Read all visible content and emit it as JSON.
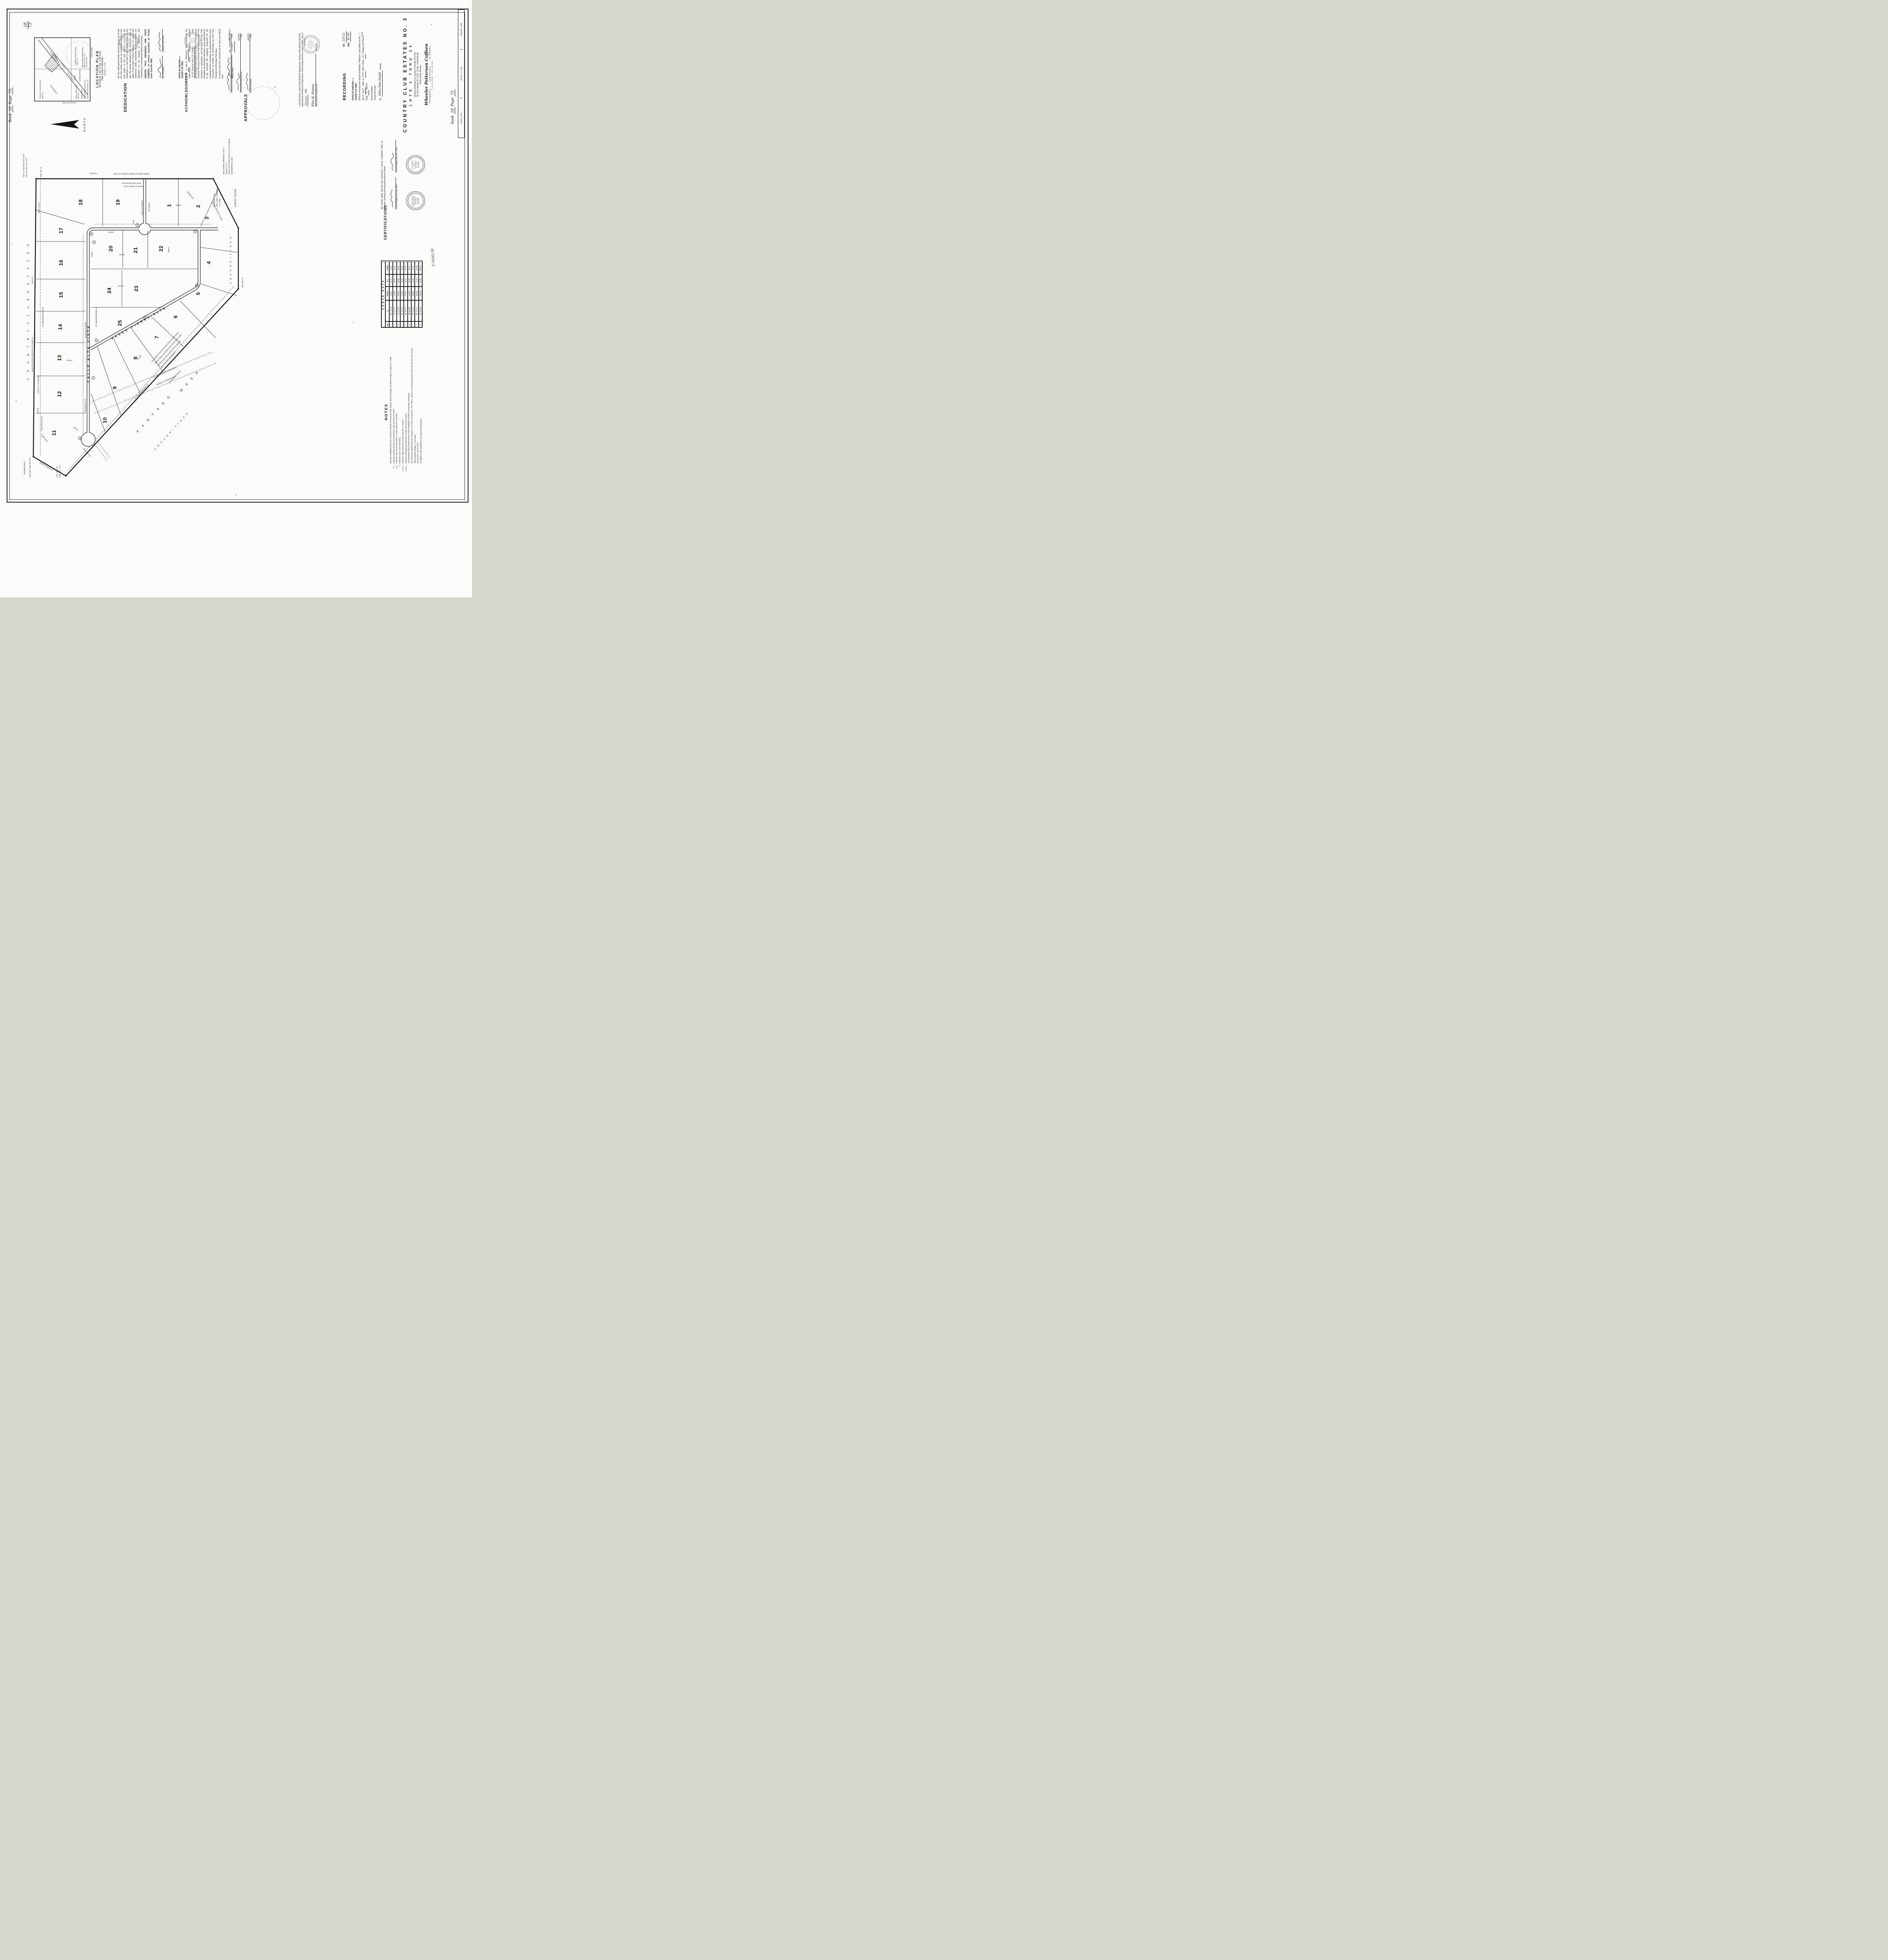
{
  "sheet": {
    "corner_note": {
      "top": "18",
      "bottom": "73"
    },
    "book_page_top": {
      "book_word": "Book",
      "book": "18",
      "page_word": "Page",
      "page": "73"
    },
    "book_page_bottom": {
      "book_word": "book",
      "book": "18",
      "page_word": "Page",
      "page": "73"
    },
    "file_number": "C-10-65-30"
  },
  "north": {
    "label": "NORTH"
  },
  "location_plan": {
    "title": "LOCATION PLAN",
    "line1": "SECTION 36, T.13S., R.14E., G.&S.R.&M.",
    "line2": "PIMA COUNTY, ARIZONA",
    "scale": "SCALE 3\" = 1 MI.",
    "labels": [
      "COUNTRY CLUB ESTATES",
      "M&P 8-75",
      "UNSUBDIVIDED",
      "PANTANO",
      "WASH",
      "UNSUBDIVIDED",
      "RAINBOW VISTA EST. ANNEX",
      "M&P 17-12",
      "SAHUARA AVENUE",
      "GLENN LOWELL ADD'N",
      "M&P 15-16",
      "GLENN STREET",
      "UNSUB.",
      "CRESTWOOD MEMORIAL PARK",
      "M&P 9-40, 9-47, 11-63,",
      "18-3, 18-4, 18-48",
      "CARLOS TERRACE M&P 12-18",
      "CASAS DE CARLOS M&P 10-96",
      "GRANT ROAD",
      "CRAYCROFT ROAD"
    ]
  },
  "dedication": {
    "heading": "DEDICATION",
    "body": "We the undersigned hereby warrant that we are all and the only parties having any record title interest in the land shown on this plat, and we consent to the subdivision of said land in the manner shown on this plat. We hereby dedicate to the use of the public all rights of way shown hereon, including all streets and easements. Utility easements as shown hereon are dedicated for the purpose of installation and maintenance of underground utilities and sewers.",
    "company": "ARIZONA TITLE INSURANCE AND TRUST COMPANY, an Arizona corporation, as Trustee under Trust No. 8008.",
    "sig1_label": "Vice President",
    "sig2_label": "Assistant Secretary",
    "seal": [
      "ARIZONA TITLE",
      "INSURANCE AND",
      "TRUST CO.",
      "· SEAL ·"
    ]
  },
  "acknowledgment": {
    "heading": "ACKNOWLEDGMENT",
    "state": "STATE OF ARIZONA",
    "ss": "s.s.",
    "county": "COUNTY OF PIMA",
    "pre": "On the",
    "day": "3",
    "mid": "day of",
    "month": "February",
    "post": "1966, before me, the undersigned officer, personally appeared",
    "names": "W. H. Driscoll and J. E. Green",
    "body2": "who acknowledged themselves to be the Vice President and Assistant Secretary of Arizona Title Insurance And Trust Company, a corporation, and that they as such Vice President and Assistant Secretary, being authorized so to do, executed the foregoing instrument for the purposes therein contained, by signing the name of the corporation, as trustee, by themselves as such Vice President and Assistant Secretary.",
    "witness": "In witness whereof I hereunto set my hand and official seal.",
    "notary_label": "Notary Public",
    "expires_pre": "My commission expires",
    "expires": "11-26-67",
    "seal": [
      "NOTARY",
      "PUBLIC",
      "PIMA CO.",
      "ARIZONA"
    ]
  },
  "approvals": {
    "heading": "APPROVALS",
    "rows": [
      {
        "label": "Sanitary District No. 1",
        "date_word": "Date",
        "date": "4/6/66"
      },
      {
        "label": "County Planning Director",
        "date_word": "Date",
        "date": "4/6/66"
      },
      {
        "label": "County Engineer",
        "date_word": "Date",
        "date": "4/6/66"
      }
    ]
  },
  "board": {
    "body_pre": "I, Elsa B. Hanna, Clerk of the Board of Supervisors, hereby certify that this plat was approved by the Board of Supervisors, Pima County, Arizona, on the",
    "day": "21st",
    "mid": "day of",
    "month": "February",
    "post": ", 1966.",
    "sig": "Elsa B. Hanna",
    "sig_label": "Clerk, Board of Supervisors",
    "date": "4/7/66",
    "seal": [
      "BOARD OF",
      "SUPERVISORS",
      "PIMA COUNTY",
      "ARIZONA"
    ]
  },
  "recording": {
    "heading": "RECORDING",
    "no_label": "NO.",
    "no": "23112",
    "fee_label": "FEE:",
    "fee": "$5.00",
    "state": "STATE OF ARIZONA",
    "ss": "s.s.",
    "county": "COUNTY OF PIMA",
    "pre": "Filed for record at the request of Wheeler, Petterson, and Coffeen on this",
    "day": "7",
    "mid1": "day of",
    "month": "April",
    "mid2": ", 1966, at",
    "time": "9:50",
    "mid3": "A.M. in Book",
    "book": "18",
    "mid4": "of Maps and Plats at Page",
    "page": "73",
    "post": "thereof.",
    "recorder": "Anna Sullinger",
    "recorder_label": "County Recorder",
    "by": "By",
    "deputy_sig": "Edna Mae Smyth",
    "deputy_label": "Deputy"
  },
  "certifications": {
    "heading": "CERTIFICATIONS",
    "body": "We hereby certify that this plat represents a survey completed under our direction; and that all monuments exist as shown.",
    "reg1": "Arizona Registration No. 2067",
    "reg2": "Arizona Registration No. 4785",
    "seal1": [
      "REGISTERED",
      "PROFESSIONAL",
      "ENGINEER",
      "No. 2067",
      "ARIZONA"
    ],
    "seal2": [
      "REGISTERED",
      "LAND",
      "SURVEYOR",
      "No. 4785",
      "ARIZONA"
    ]
  },
  "title_block": {
    "title": "COUNTRY CLUB ESTATES NO. 3",
    "subtitle": "LOTS 1 THRU 25",
    "desc1": "Being a subdivision of a portion of the NE 1/4 of the",
    "desc2": "SE 1/4 of Section 36, T.13S., R.14E., G.&S.R.B.&M.",
    "desc3": "Pima County, Arizona.",
    "firm": "Wheeler  Petterson  Coffeen",
    "roles": "ENGINEERS        SURVEYORS        PLANNERS",
    "city": "TUCSON,    ARIZONA",
    "sheet": "SHEET 1 OF 1",
    "scale": "SCALE: 1\" = 100'",
    "date": "JANUARY, 1966"
  },
  "curve_data": {
    "title": "CURVE DATA",
    "headers": [
      "No.",
      "Δ",
      "Radius",
      "S.T.",
      "Length"
    ],
    "rows": [
      [
        "1",
        "101° 32' 08\"",
        "25.00'",
        "30.62'",
        "44.30'"
      ],
      [
        "2",
        "78° 27' 57\"",
        "25.00'",
        "20.41'",
        "34.24'"
      ],
      [
        "3",
        "41° 24' 35\"",
        "50.00'",
        "18.90'",
        "36.14'"
      ],
      [
        "4",
        "90° 10' 35\"",
        "25.00'",
        "25.08'",
        "39.35'"
      ],
      [
        "5",
        "89° 49' 25\"",
        "25.00'",
        "24.92'",
        "39.19'"
      ],
      [
        "6",
        "90° 00' 00\"",
        "25.00'",
        "25.00'",
        "39.27'"
      ],
      [
        "7",
        "33° 18' 28\"",
        "150.00'",
        "44.90'",
        "87.24'"
      ],
      [
        "8",
        "50° 49' 22\"",
        "150.00'",
        "71.26'",
        "133.05'"
      ],
      [
        "9",
        "39° 10' 58\"",
        "150.00'",
        "53.38'",
        "102.57'"
      ]
    ]
  },
  "notes": {
    "heading": "NOTES",
    "items": [
      {
        "sym": "",
        "text": "Bearings established from the south line of Block 9 of Country Club Estates, Book 8 of Maps and Plats at Page 75, March 27, 1948."
      },
      {
        "sym": "—□—",
        "text": "Indicates existing survey monument found, type and size as shown."
      },
      {
        "sym": "—●—",
        "text": "Indicates new survey monument; 2\" brass cap set in concrete."
      },
      {
        "sym": "①",
        "text": "Indicates curve, see curve data."
      },
      {
        "sym": "═ U.E. ═",
        "text": "Indicates utility easement, location and size as shown."
      },
      {
        "sym": "═ D.E. ═",
        "text": "Indicates drainageway easement, location and size as shown."
      },
      {
        "sym": "",
        "text": "The Developer will not pave streets of this subdivision to Pima County Hwy. Standards."
      },
      {
        "sym": "",
        "text": "5/8\" aluminum capped steel pin, stamped \"L.S. 4785\" set at all P.C., P.T., P.R.C., and P.C.C. of all property line curves and all other lot corners."
      },
      {
        "sym": "",
        "text": "Total roadway mileage = 0.46 miles"
      },
      {
        "sym": "",
        "text": "Gross area = 21.43 acres"
      },
      {
        "sym": "",
        "text": "All utilities in this subdivision to be placed underground."
      }
    ]
  },
  "map": {
    "street1": "CALLE  ALTA  VISTA",
    "street2": "PASEO  TIERRA  ALTA",
    "lot_numbers": [
      "1",
      "2",
      "3",
      "4",
      "5",
      "6",
      "7",
      "8",
      "9",
      "10",
      "11",
      "12",
      "13",
      "14",
      "15",
      "16",
      "17",
      "18",
      "19",
      "20",
      "21",
      "22",
      "23",
      "24",
      "25"
    ],
    "curve_markers": [
      "1",
      "2",
      "3",
      "4",
      "5",
      "6",
      "7",
      "8",
      "9"
    ],
    "labels": [
      "C O U N T R Y    C L U B    E S T A T E S",
      "BOOK 8 OF MAPS AND PLATS AT PAGE 75",
      "MARCH 27, 1948",
      "BLOCK 9",
      "UNSUBDIVIDED",
      "EXIST. 5' U.E.",
      "10' UNDERGROUND U.E.",
      "FND. 2\" C.P. MK'D R-14, R-15",
      "SEC. 36, SEC. 31, T.13 S.",
      "EXISTING 10' U.E.",
      "N 89°47'17\" W   1555.66'",
      "1/16 COR. FND. 3/4\" O.P.",
      "EXCLUDED",
      "CTR. SEC. 36",
      "FND. 3/4\" L.C.P.",
      "N 0°06'29\" E  250.00'",
      "20' WALKWAY",
      "P A N T A N O",
      "W A S H",
      "U N S U B D I V I D E D",
      "N 50°36'39\" W    989.35'",
      "NO PERMITS FOR CONSTRUCTION OF BUILDINGS,",
      "STRUCTURES, OR DWELLINGS FOR HUMAN HABI-",
      "TATION SHALL BE ISSUED SOUTH AND/OR",
      "WEST OF THIS BOUNDARY.",
      "60' DRAINAGEWAY EASEMENT",
      "PAVED 20' DRAINAGEWAY",
      "15' UNDERGROUND U.E.",
      "16' UNDERGROUND U.E.",
      "FND. 5/8\" I.P.",
      "U N S U B D I V I D E D",
      "SOUTH LINE SECTION 36",
      "TOWNSHIP COR.",
      "FND. CONC. STAMPED",
      "\"L.S. 4785\"",
      "GRANT ROAD",
      "MILLSTONE COMMERCIAL NO. 1",
      "BLOCKS 1 & 2",
      "BOOK 16 OF MAPS AND PLATS AT PAGE 58",
      "NOVEMBER 23, 1962",
      "BLOCK 2",
      "EAST LINE SECTION 36",
      "450.65'  N 0°02'08\" E (M.)",
      "NORTH (REC)  N 0°02'00\" E (MEAS.)  1770.86'",
      "25.00' N 0°02'08\" E",
      "R=50'",
      "80' RADIAL",
      "FND. 1/2\" I.P.",
      "EXCLUDED",
      "EXISTING 5' U.E.",
      "246.00'",
      "170.00'",
      "160.00'",
      "190.00'",
      "153.00'",
      "165.08'",
      "108.91'",
      "215.00'",
      "315.80'",
      "120.00'",
      "N 0°12'43\" E  160.00'"
    ]
  }
}
